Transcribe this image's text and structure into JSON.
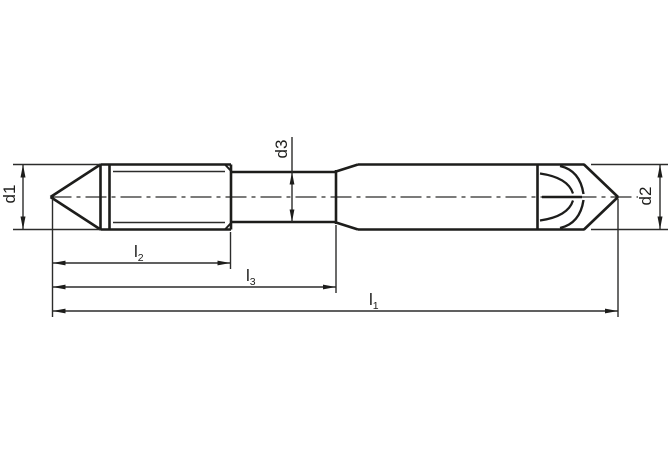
{
  "drawing": {
    "description": "Technical dimension drawing of a double-end stud (pointed tips, threaded ends, waisted centre shank)",
    "background_color": "#ffffff",
    "outline_color": "#1d1d1b",
    "thin_line_color": "#2c2c2b",
    "labels": {
      "d1": "d1",
      "d2": "d2",
      "d3": "d3",
      "l1": {
        "main": "l",
        "sub": "1"
      },
      "l2": {
        "main": "l",
        "sub": "2"
      },
      "l3": {
        "main": "l",
        "sub": "3"
      }
    }
  }
}
